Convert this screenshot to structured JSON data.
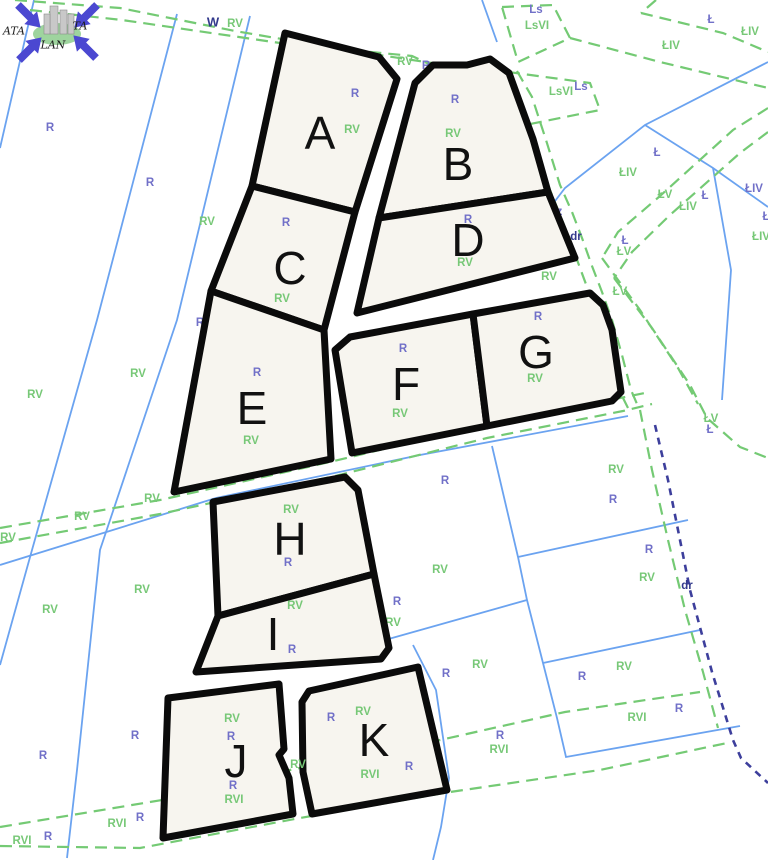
{
  "map": {
    "type": "cadastral-parcel-map",
    "background": "#ffffff",
    "colors": {
      "parcel_fill": "#f7f5ef",
      "parcel_outline": "#0b0b0b",
      "cadastral_line_blue": "#6ba3f0",
      "landuse_dashed_green": "#74ca74",
      "road_dashed_navy": "#3d3f9c",
      "label_green": "#77c877",
      "label_purple": "#7170c8",
      "label_navy": "#333a8c"
    },
    "watermark": {
      "texts": [
        {
          "t": "ATA",
          "x": 14,
          "y": 31
        },
        {
          "t": "TA",
          "x": 80,
          "y": 26
        },
        {
          "t": "LAN",
          "x": 53,
          "y": 45
        }
      ],
      "arrow_color": "#4b48d1",
      "ellipse_color": "#9ed49e",
      "building_color": "#c8c8c8",
      "arrows": [
        [
          30,
          17,
          45
        ],
        [
          85,
          17,
          135
        ],
        [
          31,
          48,
          -45
        ],
        [
          84,
          46,
          -135
        ]
      ],
      "buildings": [
        [
          50,
          6,
          8,
          28
        ],
        [
          60,
          10,
          7,
          24
        ],
        [
          44,
          14,
          6,
          20
        ],
        [
          68,
          14,
          6,
          20
        ]
      ]
    },
    "parcels": [
      {
        "id": "A",
        "points": "285,33 379,57 397,79 355,212 252,186",
        "letter": {
          "x": 320,
          "y": 133
        },
        "labels": [
          {
            "t": "R",
            "x": 355,
            "y": 94,
            "c": "p"
          },
          {
            "t": "RV",
            "x": 352,
            "y": 130,
            "c": "g"
          }
        ]
      },
      {
        "id": "B",
        "points": "415,83 433,65 467,65 490,59 509,73 533,139 548,192 379,218",
        "letter": {
          "x": 458,
          "y": 164
        },
        "labels": [
          {
            "t": "R",
            "x": 455,
            "y": 100,
            "c": "p"
          },
          {
            "t": "RV",
            "x": 453,
            "y": 134,
            "c": "g"
          }
        ]
      },
      {
        "id": "C",
        "points": "252,186 355,212 324,330 211,291",
        "letter": {
          "x": 290,
          "y": 268
        },
        "labels": [
          {
            "t": "R",
            "x": 286,
            "y": 223,
            "c": "p"
          },
          {
            "t": "RV",
            "x": 282,
            "y": 299,
            "c": "g"
          }
        ]
      },
      {
        "id": "D",
        "points": "379,218 548,192 575,258 357,313",
        "letter": {
          "x": 468,
          "y": 240
        },
        "labels": [
          {
            "t": "R",
            "x": 468,
            "y": 220,
            "c": "p"
          },
          {
            "t": "RV",
            "x": 465,
            "y": 263,
            "c": "g"
          }
        ]
      },
      {
        "id": "E",
        "points": "211,291 324,330 331,459 174,492",
        "letter": {
          "x": 252,
          "y": 408
        },
        "labels": [
          {
            "t": "R",
            "x": 257,
            "y": 373,
            "c": "p"
          },
          {
            "t": "RV",
            "x": 251,
            "y": 441,
            "c": "g"
          }
        ]
      },
      {
        "id": "F",
        "points": "335,350 350,337 473,314 487,426 352,453",
        "letter": {
          "x": 406,
          "y": 384
        },
        "labels": [
          {
            "t": "R",
            "x": 403,
            "y": 349,
            "c": "p"
          },
          {
            "t": "RV",
            "x": 400,
            "y": 414,
            "c": "g"
          }
        ]
      },
      {
        "id": "G",
        "points": "473,314 590,293 603,305 612,330 621,392 612,401 487,426",
        "letter": {
          "x": 536,
          "y": 352
        },
        "labels": [
          {
            "t": "R",
            "x": 538,
            "y": 317,
            "c": "p"
          },
          {
            "t": "RV",
            "x": 535,
            "y": 379,
            "c": "g"
          }
        ]
      },
      {
        "id": "H",
        "points": "213,502 345,477 358,490 374,574 218,616",
        "letter": {
          "x": 290,
          "y": 539
        },
        "labels": [
          {
            "t": "RV",
            "x": 291,
            "y": 510,
            "c": "g"
          },
          {
            "t": "R",
            "x": 288,
            "y": 563,
            "c": "p"
          }
        ]
      },
      {
        "id": "I",
        "points": "218,616 374,574 389,648 381,659 196,672",
        "letter": {
          "x": 273,
          "y": 634
        },
        "labels": [
          {
            "t": "RV",
            "x": 295,
            "y": 606,
            "c": "g"
          },
          {
            "t": "R",
            "x": 292,
            "y": 650,
            "c": "p"
          }
        ]
      },
      {
        "id": "J",
        "points": "168,698 279,684 284,749 279,755 289,778 293,814 163,838",
        "letter": {
          "x": 236,
          "y": 761
        },
        "labels": [
          {
            "t": "RV",
            "x": 232,
            "y": 719,
            "c": "g"
          },
          {
            "t": "R",
            "x": 231,
            "y": 737,
            "c": "p"
          },
          {
            "t": "R",
            "x": 233,
            "y": 786,
            "c": "p"
          },
          {
            "t": "RVI",
            "x": 234,
            "y": 800,
            "c": "g"
          }
        ]
      },
      {
        "id": "K",
        "points": "302,702 309,691 418,667 447,790 312,814 303,772",
        "letter": {
          "x": 374,
          "y": 740
        },
        "labels": [
          {
            "t": "RV",
            "x": 363,
            "y": 712,
            "c": "g"
          },
          {
            "t": "R",
            "x": 331,
            "y": 718,
            "c": "p"
          },
          {
            "t": "RVI",
            "x": 370,
            "y": 775,
            "c": "g"
          },
          {
            "t": "R",
            "x": 409,
            "y": 767,
            "c": "p"
          }
        ]
      }
    ],
    "overlay_labels": [
      {
        "t": "RV",
        "x": 298,
        "y": 765,
        "c": "g"
      }
    ],
    "bg_labels": [
      {
        "t": "W",
        "x": 213,
        "y": 22,
        "c": "n",
        "big": true
      },
      {
        "t": "RV",
        "x": 235,
        "y": 24,
        "c": "g"
      },
      {
        "t": "R",
        "x": 50,
        "y": 128,
        "c": "p"
      },
      {
        "t": "R",
        "x": 150,
        "y": 183,
        "c": "p"
      },
      {
        "t": "RV",
        "x": 207,
        "y": 222,
        "c": "g"
      },
      {
        "t": "R",
        "x": 200,
        "y": 323,
        "c": "p"
      },
      {
        "t": "RV",
        "x": 35,
        "y": 395,
        "c": "g"
      },
      {
        "t": "RV",
        "x": 138,
        "y": 374,
        "c": "g"
      },
      {
        "t": "RV",
        "x": 82,
        "y": 517,
        "c": "g"
      },
      {
        "t": "RV",
        "x": 8,
        "y": 538,
        "c": "g"
      },
      {
        "t": "RV",
        "x": 152,
        "y": 499,
        "c": "g"
      },
      {
        "t": "RV",
        "x": 50,
        "y": 610,
        "c": "g"
      },
      {
        "t": "RV",
        "x": 142,
        "y": 590,
        "c": "g"
      },
      {
        "t": "R",
        "x": 43,
        "y": 756,
        "c": "p"
      },
      {
        "t": "R",
        "x": 135,
        "y": 736,
        "c": "p"
      },
      {
        "t": "RVI",
        "x": 22,
        "y": 841,
        "c": "g"
      },
      {
        "t": "R",
        "x": 48,
        "y": 837,
        "c": "p"
      },
      {
        "t": "RVI",
        "x": 117,
        "y": 824,
        "c": "g"
      },
      {
        "t": "R",
        "x": 140,
        "y": 818,
        "c": "p"
      },
      {
        "t": "RV",
        "x": 405,
        "y": 62,
        "c": "g"
      },
      {
        "t": "R",
        "x": 426,
        "y": 66,
        "c": "p"
      },
      {
        "t": "Ls",
        "x": 536,
        "y": 10,
        "c": "p"
      },
      {
        "t": "LsVI",
        "x": 537,
        "y": 26,
        "c": "g"
      },
      {
        "t": "LsVI",
        "x": 561,
        "y": 92,
        "c": "g"
      },
      {
        "t": "Ls",
        "x": 581,
        "y": 87,
        "c": "p"
      },
      {
        "t": "Lz",
        "x": 508,
        "y": 114,
        "c": "p"
      },
      {
        "t": "R",
        "x": 508,
        "y": 126,
        "c": "p"
      },
      {
        "t": "Lz",
        "x": 556,
        "y": 212,
        "c": "p"
      },
      {
        "t": "R",
        "x": 557,
        "y": 224,
        "c": "g"
      },
      {
        "t": "dr",
        "x": 576,
        "y": 237,
        "c": "n"
      },
      {
        "t": "RV",
        "x": 549,
        "y": 277,
        "c": "g"
      },
      {
        "t": "Ł",
        "x": 711,
        "y": 20,
        "c": "p"
      },
      {
        "t": "ŁIV",
        "x": 750,
        "y": 32,
        "c": "g"
      },
      {
        "t": "ŁIV",
        "x": 671,
        "y": 46,
        "c": "g"
      },
      {
        "t": "Ł",
        "x": 657,
        "y": 153,
        "c": "p"
      },
      {
        "t": "ŁIV",
        "x": 628,
        "y": 173,
        "c": "g"
      },
      {
        "t": "ŁV",
        "x": 665,
        "y": 195,
        "c": "g"
      },
      {
        "t": "Ł",
        "x": 705,
        "y": 196,
        "c": "p"
      },
      {
        "t": "ŁIV",
        "x": 688,
        "y": 207,
        "c": "g"
      },
      {
        "t": "ŁIV",
        "x": 754,
        "y": 189,
        "c": "p"
      },
      {
        "t": "Ł",
        "x": 766,
        "y": 217,
        "c": "p"
      },
      {
        "t": "ŁIV",
        "x": 761,
        "y": 237,
        "c": "g"
      },
      {
        "t": "Ł",
        "x": 625,
        "y": 241,
        "c": "p"
      },
      {
        "t": "ŁV",
        "x": 624,
        "y": 252,
        "c": "g"
      },
      {
        "t": "ŁV",
        "x": 620,
        "y": 292,
        "c": "g"
      },
      {
        "t": "Ł",
        "x": 594,
        "y": 312,
        "c": "p"
      },
      {
        "t": "R",
        "x": 605,
        "y": 370,
        "c": "g"
      },
      {
        "t": "ŁV",
        "x": 711,
        "y": 419,
        "c": "g"
      },
      {
        "t": "Ł",
        "x": 710,
        "y": 430,
        "c": "p"
      },
      {
        "t": "R",
        "x": 445,
        "y": 481,
        "c": "p"
      },
      {
        "t": "RV",
        "x": 616,
        "y": 470,
        "c": "g"
      },
      {
        "t": "R",
        "x": 613,
        "y": 500,
        "c": "p"
      },
      {
        "t": "R",
        "x": 649,
        "y": 550,
        "c": "p"
      },
      {
        "t": "RV",
        "x": 647,
        "y": 578,
        "c": "g"
      },
      {
        "t": "RV",
        "x": 440,
        "y": 570,
        "c": "g"
      },
      {
        "t": "dr",
        "x": 687,
        "y": 586,
        "c": "n"
      },
      {
        "t": "R",
        "x": 397,
        "y": 602,
        "c": "p"
      },
      {
        "t": "RV",
        "x": 393,
        "y": 623,
        "c": "g"
      },
      {
        "t": "R",
        "x": 446,
        "y": 674,
        "c": "p"
      },
      {
        "t": "RV",
        "x": 480,
        "y": 665,
        "c": "g"
      },
      {
        "t": "R",
        "x": 582,
        "y": 677,
        "c": "p"
      },
      {
        "t": "RV",
        "x": 624,
        "y": 667,
        "c": "g"
      },
      {
        "t": "R",
        "x": 679,
        "y": 709,
        "c": "p"
      },
      {
        "t": "RVI",
        "x": 637,
        "y": 718,
        "c": "g"
      },
      {
        "t": "R",
        "x": 500,
        "y": 736,
        "c": "p"
      },
      {
        "t": "RVI",
        "x": 499,
        "y": 750,
        "c": "g"
      }
    ],
    "blue_lines": [
      "34,0 0,148",
      "177,14 97,320 32,550 0,665",
      "250,16 177,320 100,550 77,770 67,858",
      "482,0 497,42",
      "768,62 645,125 565,188 552,205",
      "645,125 713,168 768,207",
      "713,168 731,270 722,400",
      "0,565 216,498 420,455 628,416",
      "492,446 518,557 527,600 543,663 557,718 566,757 740,726",
      "518,557 688,520",
      "543,663 700,630",
      "385,640 527,600",
      "413,645 436,690 449,778 441,827 433,860"
    ],
    "green_dashed": [
      "15,0 120,8 235,31 340,49 445,65",
      "30,10 122,20 280,43 412,56 448,73 505,96",
      "502,7 553,5 570,38 518,62 502,7",
      "508,72 590,83 600,110 525,125 508,72",
      "656,0 641,13",
      "641,13 723,33 768,52",
      "570,38 660,62 768,88",
      "506,78 520,100 533,140 548,185 560,215 570,240 580,268 590,295 600,322 612,360 620,392 628,408",
      "517,71 532,97 546,140 560,185 572,212 582,238 592,266 602,292 612,320 622,355 631,390 637,404",
      "768,108 733,130 660,196 618,232 602,258",
      "768,132 740,153 670,215 632,252 614,278",
      "602,258 640,310 678,368 698,404",
      "614,278 652,328 690,385 707,418 740,447 768,458",
      "640,410 652,470 668,540 685,610 703,672 718,728",
      "0,827 162,800 290,770 440,740 565,712 700,692",
      "0,846 140,848 300,818 450,792 600,770 727,743",
      "0,528 160,500 330,462 483,425 620,398 650,392",
      "0,543 160,514 335,476 487,438 623,411 652,404"
    ],
    "navy_dashed": [
      "655,425 668,480 690,590 712,672 733,740 741,758 768,783"
    ]
  }
}
